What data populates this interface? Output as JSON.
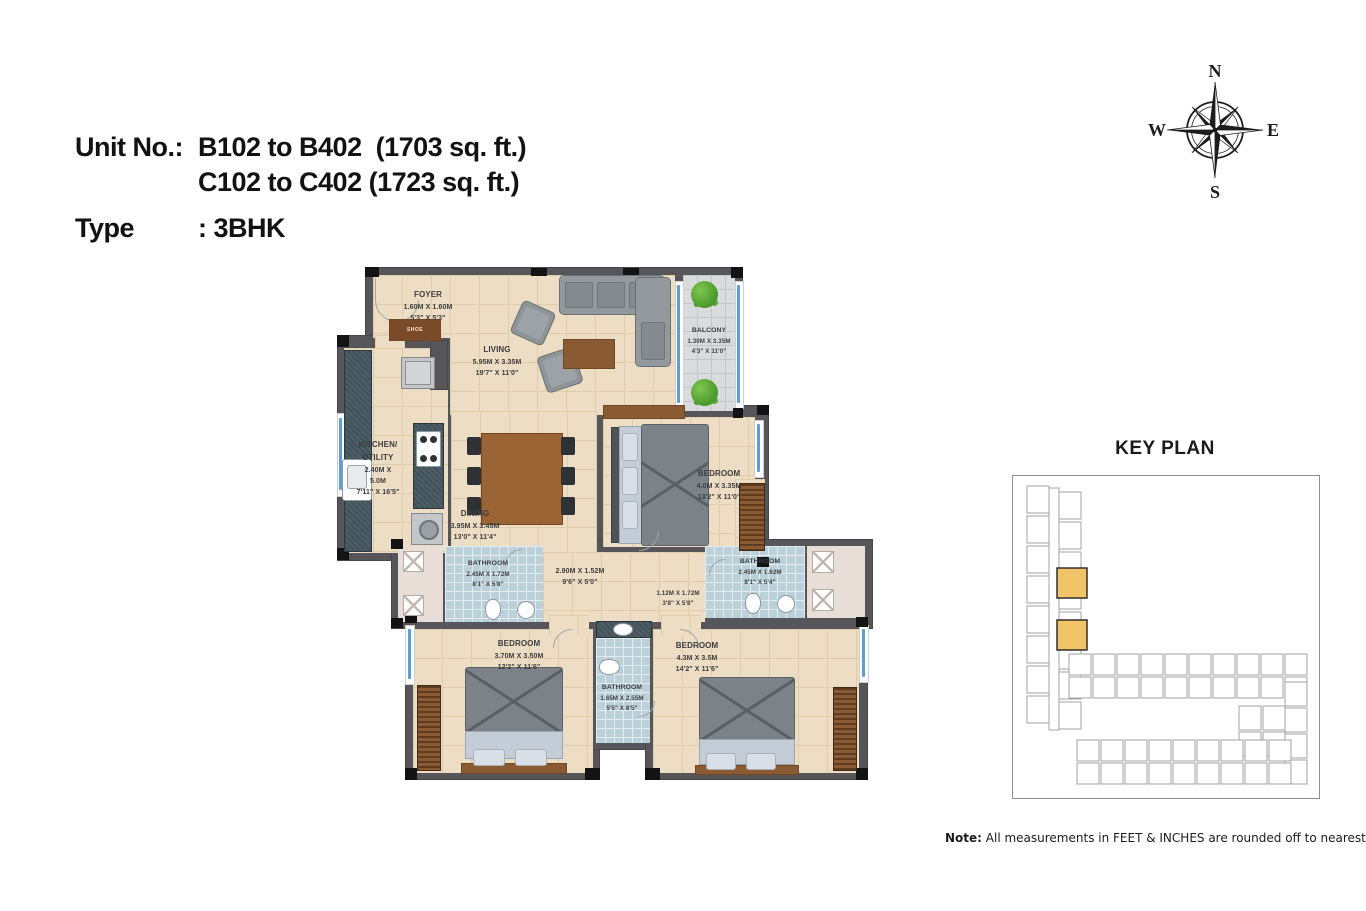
{
  "title": {
    "line1_label": "Unit No.:",
    "line1_value": "B102 to B402  (1703 sq. ft.)",
    "line2_value": "C102 to C402 (1723 sq. ft.)",
    "line3_label": "Type",
    "line3_value": ": 3BHK"
  },
  "compass": {
    "n": "N",
    "e": "E",
    "s": "S",
    "w": "W"
  },
  "key_plan": {
    "title": "KEY PLAN",
    "highlight_color": "#F2C468"
  },
  "note": {
    "label": "Note:",
    "text": " All measurements in FEET & INCHES are rounded off to nearest decimal"
  },
  "furniture": {
    "shoe_label": "SHOE"
  },
  "colors": {
    "wall": "#55555A",
    "floor_tile": "#ECDDC4",
    "bathroom_tile": "#BCD0D9",
    "balcony_tile": "#DADBDC",
    "duct_pink": "#E9DDD7",
    "window_blue": "#5D9FD4",
    "wood_brown": "#9A6434",
    "highlight_orange": "#F2C468"
  },
  "rooms": [
    {
      "name": "FOYER",
      "metric": "1.60M X 1.60M",
      "imperial": "5'3\" X 5'3\""
    },
    {
      "name": "LIVING",
      "metric": "5.95M X 3.35M",
      "imperial": "19'7\" X 11'0\""
    },
    {
      "name": "BALCONY",
      "metric": "1.30M X 3.35M",
      "imperial": "4'3\" X 11'0\""
    },
    {
      "name": "KITCHEN/",
      "name2": "UTILITY",
      "metric": "2.40M X",
      "metric2": "5.0M",
      "imperial": "7'11\" X 16'5\""
    },
    {
      "name": "DINING",
      "metric": "3.95M X 3.45M",
      "imperial": "13'0\" X 11'4\""
    },
    {
      "name": "BEDROOM",
      "metric": "4.0M X 3.35M",
      "imperial": "13'2\" X 11'0\""
    },
    {
      "name": "BATHROOM",
      "metric": "2.45M X 1.72M",
      "imperial": "8'1\" X 5'8\""
    },
    {
      "name": "",
      "metric": "2.90M X 1.52M",
      "imperial": "9'6\" X 5'0\""
    },
    {
      "name": "",
      "metric": "1.12M X 1.72M",
      "imperial": "3'8\" X 5'8\""
    },
    {
      "name": "BATHROOM",
      "metric": "2.45M X 1.62M",
      "imperial": "8'1\" X 5'4\""
    },
    {
      "name": "BEDROOM",
      "metric": "3.70M X 3.50M",
      "imperial": "12'2\" X 11'6\""
    },
    {
      "name": "BATHROOM",
      "metric": "1.65M X 2.55M",
      "imperial": "5'5\" X 8'5\""
    },
    {
      "name": "BEDROOM",
      "metric": "4.3M X 3.5M",
      "imperial": "14'2\" X 11'6\""
    }
  ]
}
